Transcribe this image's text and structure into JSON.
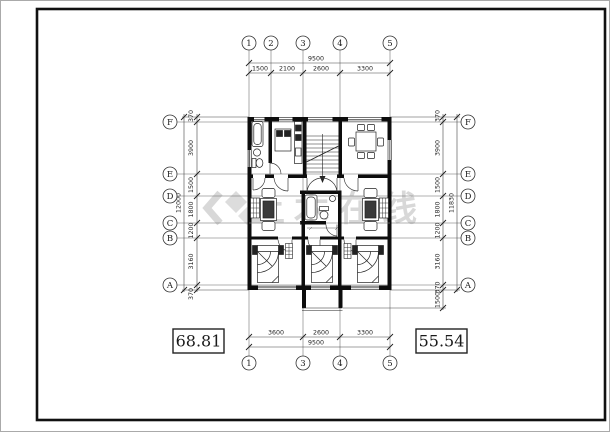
{
  "drawing": {
    "type": "architectural-floor-plan",
    "axes": {
      "top": [
        "1",
        "2",
        "3",
        "4",
        "5"
      ],
      "bottom": [
        "1",
        "3",
        "4",
        "5"
      ],
      "left": [
        "F",
        "E",
        "D",
        "C",
        "B",
        "A"
      ],
      "right": [
        "F",
        "E",
        "D",
        "C",
        "B",
        "A"
      ]
    },
    "dims": {
      "top": {
        "total": "9500",
        "segments": [
          "1500",
          "2100",
          "2600",
          "3300"
        ]
      },
      "bottom": {
        "total": "9500",
        "segments": [
          "3600",
          "2600",
          "3300"
        ]
      },
      "left": {
        "total": "12000",
        "segments": [
          "370",
          "3900",
          "1500",
          "1800",
          "1200",
          "3160",
          "370"
        ]
      },
      "right": {
        "total": "11830",
        "segments": [
          "370",
          "3900",
          "1500",
          "1800",
          "1200",
          "3160",
          "370",
          "1500"
        ]
      }
    },
    "areas": {
      "left": "68.81",
      "right": "55.54"
    },
    "watermark": {
      "text": "土木在线",
      "color": "#d8d8d8"
    },
    "colors": {
      "line": "#1a1a1a",
      "grid": "#666666",
      "wall": "#0d0d0d"
    }
  }
}
